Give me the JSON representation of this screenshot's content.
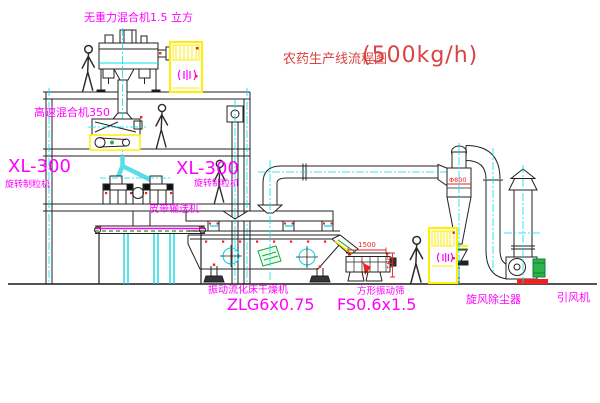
{
  "image_type": "CAD process flow diagram of a pesticide granule production line",
  "title": {
    "text": "农药生产线流程图",
    "capacity": "(500kg/h)"
  },
  "equipment_labels": {
    "gravity_mixer": "无重力混合机1.5 立方",
    "high_speed_mixer": "高速混合机350",
    "granulator_left_model": "XL-300",
    "granulator_left_name": "旋转制粒机",
    "granulator_center_model": "XL-300",
    "granulator_center_name": "旋转制粒机",
    "belt_conveyor": "皮带输送机",
    "fluid_bed_dryer_name": "振动流化床干燥机",
    "fluid_bed_dryer_model": "ZLG6x0.75",
    "vibrating_screen_name": "方形振动筛",
    "vibrating_screen_model": "FS0.6x1.5",
    "cyclone": "旋风除尘器",
    "induced_draft_fan": "引风机"
  },
  "dimensions": {
    "cyclone_diameter": "Φ800",
    "screen_length": "1500",
    "screen_height": "541"
  },
  "colors": {
    "label_magenta": "#ff00ff",
    "title_red": "#d94343",
    "dimension_red": "#ee2222",
    "centerline_cyan": "#00e0ee",
    "cabinet_yellow": "#ffee00",
    "motor_green": "#2ab34a",
    "line_black": "#222222",
    "background": "#ffffff"
  }
}
